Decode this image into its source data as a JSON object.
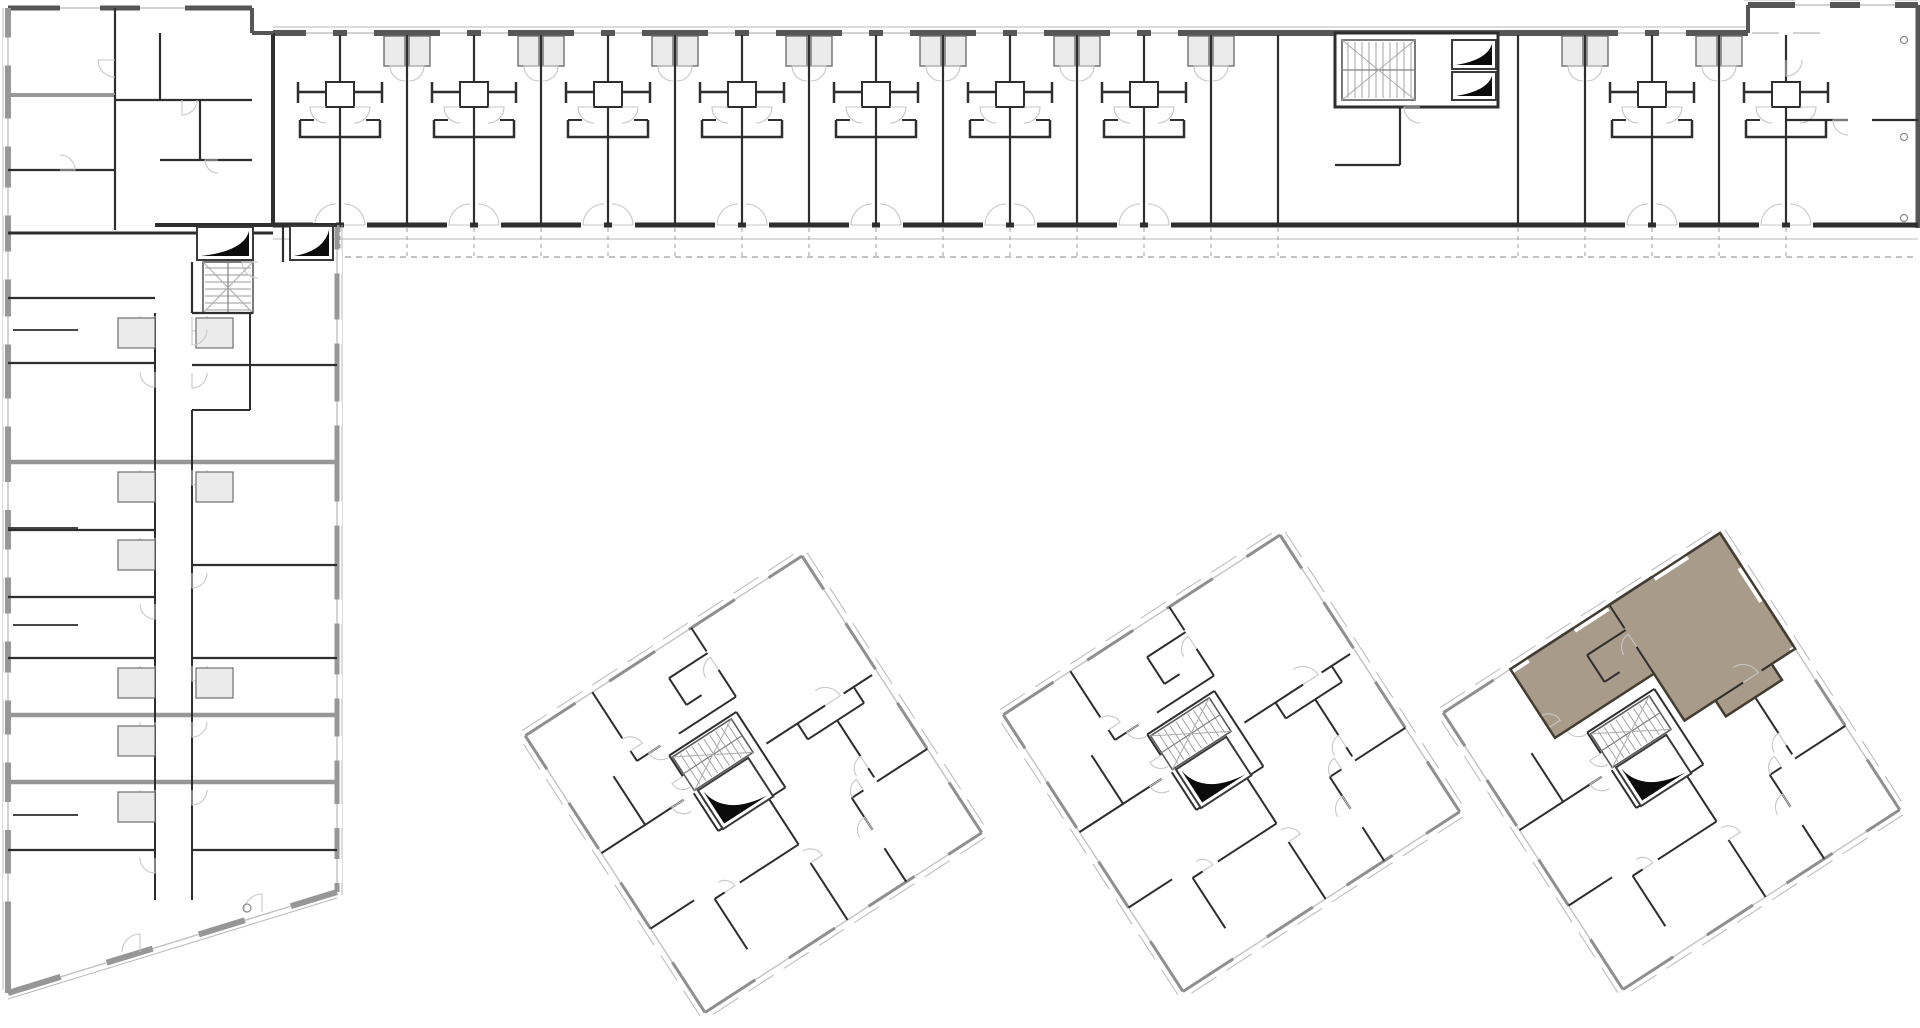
{
  "meta": {
    "label": "Architectural site floor plan: L-shaped residential block with gallery-access apartments and three rotated point towers; one apartment in the right tower highlighted",
    "highlighted_unit": {
      "building": "tower-3",
      "position": "top corner",
      "fill": "#a89b89"
    }
  },
  "palette": {
    "bg": "#ffffff",
    "wallDark": "#2e2e2e",
    "wallMid": "#565656",
    "hatch": "#979797",
    "thin": "#b8b8b8",
    "arc": "#c7c7c7",
    "dash": "#9e9e9e",
    "glass": "#c2c2c2",
    "black": "#0b0b0b",
    "podFill": "#ebebeb",
    "tread": "#9a9a9a",
    "stairX": "#ababab",
    "highlightFill": "#a89b89",
    "highlightEdge": "#433c31"
  },
  "canvas": {
    "w": 1920,
    "h": 1028
  },
  "topWing": {
    "x0": 273,
    "x1": 1918,
    "yOuter": 27,
    "yTop": 33,
    "yBottom": 225,
    "thinY": 239,
    "dashY": 257,
    "dashX0": 345,
    "upperBlock": [
      1748,
      5,
      1918,
      33
    ],
    "partyWalls": [
      340,
      407,
      474,
      541,
      608,
      675,
      742,
      809,
      876,
      943,
      1010,
      1077,
      1144,
      1211,
      1278,
      1518,
      1585,
      1652,
      1719,
      1786
    ],
    "hWalls": [
      340,
      474,
      608,
      742,
      876,
      1010,
      1144,
      1652,
      1786
    ],
    "podWalls": [
      407,
      541,
      675,
      809,
      943,
      1077,
      1211,
      1585,
      1719
    ],
    "endTopWindows": [
      [
        1795,
        1830
      ],
      [
        1860,
        1895
      ]
    ],
    "core": {
      "box": [
        1335,
        33,
        1498,
        107
      ],
      "stairs": [
        1342,
        40,
        1415,
        100
      ],
      "elevators": [
        [
          1452,
          40,
          1496,
          69
        ],
        [
          1452,
          72,
          1496,
          100
        ]
      ],
      "walls": [
        [
          1400,
          107,
          1400,
          165
        ],
        [
          1335,
          165,
          1400,
          165
        ]
      ]
    },
    "endUnit": {
      "divSegs": [
        [
          1786,
          120,
          1848,
          120
        ],
        [
          1872,
          120,
          1918,
          120
        ]
      ],
      "circles": [
        [
          1904,
          40
        ],
        [
          1904,
          137
        ],
        [
          1904,
          218
        ]
      ]
    }
  },
  "leftWing": {
    "west": 8,
    "east": 337,
    "yTop": 8,
    "yBotWest": 993,
    "diagEnd": [
      337,
      892
    ],
    "cornerBlock": {
      "x1": 252,
      "stepY": 33,
      "walls": [
        [
          115,
          8,
          115,
          95
        ],
        [
          8,
          95,
          115,
          95
        ],
        [
          8,
          170,
          115,
          170
        ],
        [
          115,
          95,
          115,
          230
        ],
        [
          160,
          33,
          160,
          100
        ],
        [
          115,
          100,
          252,
          100
        ],
        [
          200,
          100,
          200,
          160
        ],
        [
          160,
          160,
          252,
          160
        ]
      ],
      "arcs": [
        [
          115,
          60,
          17,
          90,
          180
        ],
        [
          60,
          170,
          15,
          270,
          0
        ],
        [
          182,
          100,
          15,
          0,
          90
        ],
        [
          218,
          160,
          13,
          90,
          180
        ]
      ],
      "topWindows": [
        [
          60,
          100
        ],
        [
          140,
          185
        ]
      ]
    },
    "divider233": [
      8,
      233,
      273,
      233
    ],
    "westDividers": [
      298,
      363,
      462,
      530,
      597,
      658,
      715,
      782,
      850
    ],
    "fullDividers": [
      462,
      715,
      782
    ],
    "eastDividers": [
      365,
      565,
      658,
      850
    ],
    "stubs": [
      [
        8,
        330,
        78,
        330
      ],
      [
        8,
        528,
        78,
        528
      ],
      [
        8,
        625,
        78,
        625
      ],
      [
        8,
        815,
        78,
        815
      ]
    ],
    "corridor": {
      "w1": 155,
      "w2": 192,
      "top": 313,
      "bot": 900,
      "jogX": 250,
      "jogY": 410
    },
    "core": {
      "bottomWall": [
        155,
        225,
        337,
        225
      ],
      "elevators": [
        [
          197,
          227,
          253,
          260
        ],
        [
          290,
          226,
          333,
          260
        ]
      ],
      "stairs": [
        203,
        262,
        253,
        313
      ],
      "walls": [
        [
          192,
          313,
          253,
          313
        ],
        [
          192,
          262,
          192,
          313
        ],
        [
          283,
          225,
          283,
          262
        ]
      ],
      "arcs": [
        [
          258,
          262,
          16,
          90,
          180
        ],
        [
          192,
          330,
          15,
          0,
          90
        ]
      ]
    },
    "pods": [
      [
        118,
        318
      ],
      [
        118,
        472
      ],
      [
        118,
        540
      ],
      [
        118,
        668
      ],
      [
        118,
        726
      ],
      [
        118,
        792
      ],
      [
        196,
        318
      ],
      [
        196,
        472
      ],
      [
        196,
        668
      ]
    ],
    "doorYsWest": [
      316,
      372,
      470,
      538,
      604,
      666,
      722,
      790,
      858
    ],
    "doorYsEast": [
      316,
      373,
      470,
      573,
      666,
      722,
      790
    ],
    "westWindowsRef": [
      8,
      95,
      170,
      233,
      298,
      363,
      462,
      530,
      597,
      658,
      715,
      782,
      850,
      925
    ],
    "eastWindowsRef": [
      225,
      298,
      365,
      462,
      565,
      658,
      715,
      782,
      850,
      892
    ],
    "diagWindows": [
      [
        0.16,
        0.3
      ],
      [
        0.44,
        0.58
      ],
      [
        0.72,
        0.86
      ]
    ],
    "diagCircle": [
      247,
      908
    ]
  },
  "towers": {
    "side": 330,
    "rotation": 57,
    "tops": [
      [
        802,
        556
      ],
      [
        1280,
        535
      ],
      [
        1720,
        533
      ]
    ],
    "walls": [
      [
        138,
        6,
        138,
        40
      ],
      [
        138,
        62,
        138,
        132
      ],
      [
        0,
        132,
        28,
        132
      ],
      [
        50,
        132,
        82,
        132
      ],
      [
        82,
        132,
        82,
        200
      ],
      [
        82,
        222,
        82,
        250
      ],
      [
        0,
        250,
        55,
        250
      ],
      [
        70,
        250,
        82,
        250
      ],
      [
        157,
        28,
        157,
        95
      ],
      [
        138,
        28,
        157,
        28
      ],
      [
        138,
        95,
        157,
        95
      ],
      [
        95,
        140,
        185,
        140
      ],
      [
        95,
        140,
        95,
        220
      ],
      [
        95,
        220,
        120,
        220
      ],
      [
        140,
        220,
        185,
        220
      ],
      [
        185,
        140,
        185,
        168
      ],
      [
        185,
        190,
        185,
        220
      ],
      [
        157,
        60,
        200,
        60
      ],
      [
        214,
        60,
        225,
        60
      ],
      [
        230,
        0,
        230,
        60
      ],
      [
        230,
        76,
        230,
        90
      ],
      [
        230,
        90,
        268,
        90
      ],
      [
        290,
        90,
        330,
        90
      ],
      [
        185,
        160,
        240,
        160
      ],
      [
        262,
        160,
        330,
        160
      ],
      [
        240,
        160,
        240,
        230
      ],
      [
        240,
        248,
        240,
        260
      ],
      [
        240,
        260,
        300,
        260
      ],
      [
        140,
        232,
        140,
        330
      ],
      [
        82,
        278,
        140,
        278
      ],
      [
        230,
        278,
        230,
        330
      ],
      [
        30,
        132,
        30,
        178
      ],
      [
        30,
        178,
        62,
        178
      ],
      [
        62,
        160,
        62,
        178
      ]
    ],
    "arcs": [
      [
        138,
        62,
        18,
        180,
        270
      ],
      [
        50,
        132,
        15,
        90,
        180
      ],
      [
        82,
        222,
        14,
        0,
        90
      ],
      [
        70,
        250,
        14,
        180,
        270
      ],
      [
        120,
        220,
        13,
        0,
        90
      ],
      [
        214,
        60,
        14,
        90,
        180
      ],
      [
        268,
        90,
        15,
        90,
        180
      ],
      [
        262,
        160,
        14,
        180,
        270
      ],
      [
        240,
        248,
        12,
        180,
        270
      ],
      [
        140,
        232,
        14,
        0,
        90
      ],
      [
        230,
        76,
        13,
        90,
        180
      ]
    ],
    "windows": [
      [
        40,
        80
      ],
      [
        135,
        175
      ],
      [
        230,
        270
      ]
    ],
    "core": {
      "stairs": [
        98,
        148,
        138,
        218
      ],
      "elevator": [
        140,
        155,
        186,
        215
      ]
    },
    "highlight": {
      "towerIndex": 2,
      "polygon": [
        [
          0,
          0
        ],
        [
          138,
          0
        ],
        [
          138,
          28
        ],
        [
          157,
          28
        ],
        [
          157,
          95
        ],
        [
          138,
          95
        ],
        [
          138,
          132
        ],
        [
          82,
          132
        ],
        [
          82,
          250
        ],
        [
          0,
          250
        ]
      ]
    }
  }
}
